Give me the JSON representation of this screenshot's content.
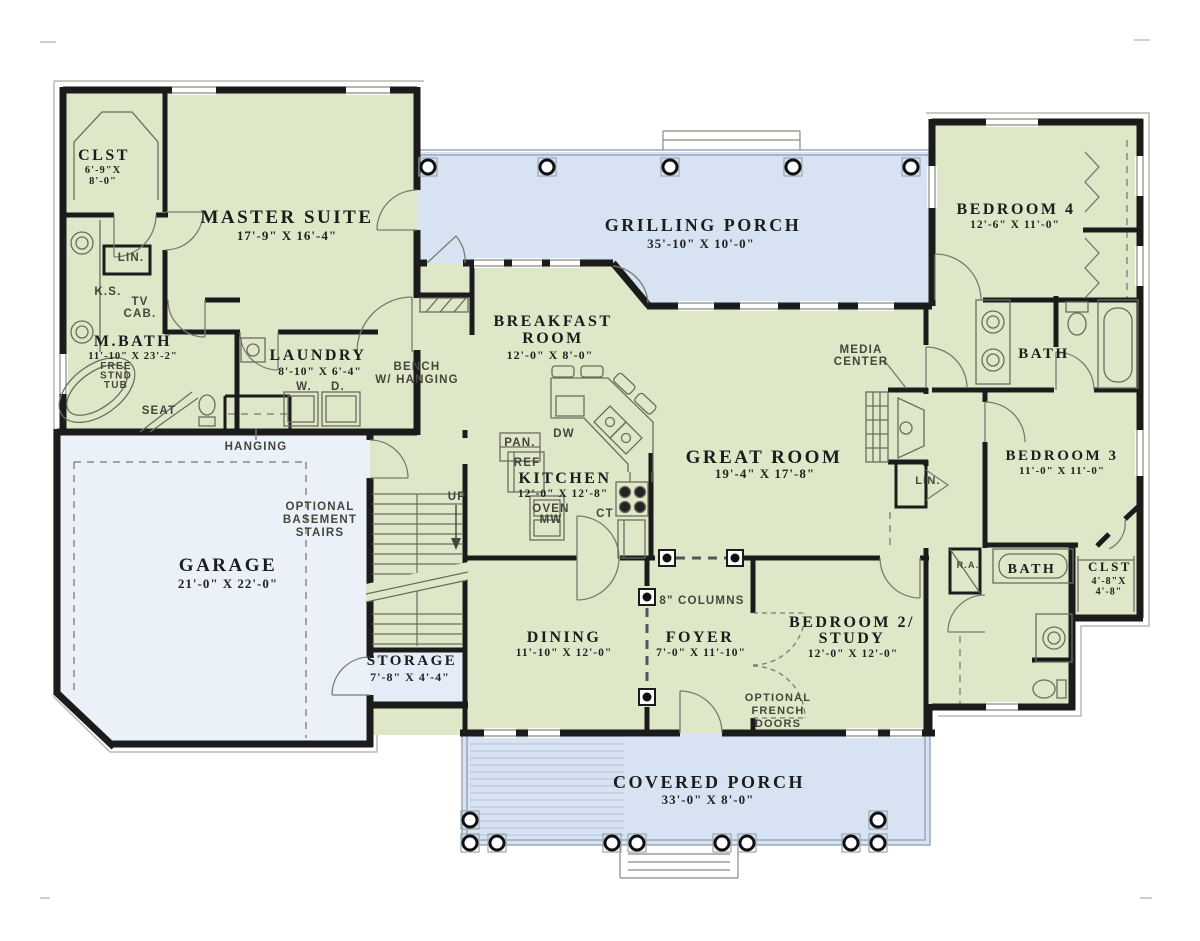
{
  "drawing": "single-story house first floor plan",
  "colors": {
    "wall": "#1b1b1b",
    "room_fill": "#dee8c9",
    "porch_fill": "#d7e3f2",
    "garage_fill": "#ebf1f8",
    "storage_fill": "#e3ecf7",
    "room_text": "#1c1c1c",
    "note_text": "#45453c",
    "fixture_line": "#6b6b5e"
  },
  "labels": [
    {
      "id": "clst-left-name",
      "cls": "room",
      "x": 104,
      "y": 160,
      "size": 16,
      "lines": [
        "CLST"
      ]
    },
    {
      "id": "clst-left-dim",
      "cls": "dim",
      "x": 103,
      "y": 173,
      "size": 10.5,
      "lh": 11,
      "lines": [
        "6'-9\"X",
        "8'-0\""
      ]
    },
    {
      "id": "master-suite-name",
      "cls": "room",
      "x": 287,
      "y": 223,
      "size": 19,
      "lines": [
        "MASTER SUITE"
      ]
    },
    {
      "id": "master-suite-dim",
      "cls": "dim",
      "x": 287,
      "y": 240,
      "size": 13,
      "lines": [
        "17'-9\" X 16'-4\""
      ]
    },
    {
      "id": "lin-left",
      "cls": "note",
      "x": 131,
      "y": 261,
      "size": 11.5,
      "lines": [
        "LIN."
      ]
    },
    {
      "id": "ks",
      "cls": "note",
      "x": 108,
      "y": 295,
      "size": 11.5,
      "lines": [
        "K.S."
      ]
    },
    {
      "id": "tv-cab",
      "cls": "note",
      "x": 140,
      "y": 305,
      "size": 11.5,
      "lh": 12,
      "lines": [
        "TV",
        "CAB."
      ]
    },
    {
      "id": "m-bath-name",
      "cls": "room",
      "x": 133,
      "y": 346,
      "size": 16,
      "lines": [
        "M.BATH"
      ]
    },
    {
      "id": "m-bath-dim",
      "cls": "dim",
      "x": 133,
      "y": 359,
      "size": 10.5,
      "lines": [
        "11'-10\" X 23'-2\""
      ]
    },
    {
      "id": "free-stnd-tub",
      "cls": "note",
      "x": 116,
      "y": 369,
      "size": 10,
      "lh": 9.5,
      "lines": [
        "FREE",
        "STND",
        "TUB"
      ]
    },
    {
      "id": "seat",
      "cls": "note",
      "x": 159,
      "y": 414,
      "size": 11.5,
      "lines": [
        "SEAT"
      ]
    },
    {
      "id": "hanging-left",
      "cls": "note",
      "x": 256,
      "y": 450,
      "size": 11.5,
      "lines": [
        "HANGING"
      ]
    },
    {
      "id": "laundry-name",
      "cls": "room",
      "x": 318,
      "y": 360,
      "size": 16,
      "lines": [
        "LAUNDRY"
      ]
    },
    {
      "id": "laundry-dim",
      "cls": "dim",
      "x": 320,
      "y": 375,
      "size": 11.5,
      "lines": [
        "8'-10\" X 6'-4\""
      ]
    },
    {
      "id": "washer",
      "cls": "note",
      "x": 304,
      "y": 390,
      "size": 11.5,
      "lines": [
        "W."
      ]
    },
    {
      "id": "dryer",
      "cls": "note",
      "x": 338,
      "y": 390,
      "size": 11.5,
      "lines": [
        "D."
      ]
    },
    {
      "id": "bench-hanging",
      "cls": "note",
      "x": 417,
      "y": 370,
      "size": 11.5,
      "lh": 13,
      "lines": [
        "BENCH",
        "W/ HANGING"
      ]
    },
    {
      "id": "garage-name",
      "cls": "room",
      "x": 228,
      "y": 571,
      "size": 19,
      "lines": [
        "GARAGE"
      ]
    },
    {
      "id": "garage-dim",
      "cls": "dim",
      "x": 228,
      "y": 588,
      "size": 13,
      "lines": [
        "21'-0\" X 22'-0\""
      ]
    },
    {
      "id": "optional-basement",
      "cls": "note",
      "x": 320,
      "y": 510,
      "size": 11.5,
      "lh": 13,
      "lines": [
        "OPTIONAL",
        "BASEMENT",
        "STAIRS"
      ]
    },
    {
      "id": "up",
      "cls": "note",
      "x": 457,
      "y": 500,
      "size": 11.5,
      "lines": [
        "UP"
      ]
    },
    {
      "id": "storage-name",
      "cls": "room",
      "x": 412,
      "y": 665,
      "size": 15,
      "lines": [
        "STORAGE"
      ]
    },
    {
      "id": "storage-dim",
      "cls": "dim",
      "x": 410,
      "y": 681,
      "size": 12,
      "lines": [
        "7'-8\" X 4'-4\""
      ]
    },
    {
      "id": "grilling-porch-name",
      "cls": "room",
      "x": 703,
      "y": 231,
      "size": 18,
      "lines": [
        "GRILLING PORCH"
      ]
    },
    {
      "id": "grilling-porch-dim",
      "cls": "dim",
      "x": 701,
      "y": 248,
      "size": 13,
      "lines": [
        "35'-10\" X 10'-0\""
      ]
    },
    {
      "id": "breakfast-name",
      "cls": "room",
      "x": 553,
      "y": 326,
      "size": 16,
      "lh": 17,
      "lines": [
        "BREAKFAST",
        "ROOM"
      ]
    },
    {
      "id": "breakfast-dim",
      "cls": "dim",
      "x": 550,
      "y": 359,
      "size": 12,
      "lines": [
        "12'-0\" X 8'-0\""
      ]
    },
    {
      "id": "media-center",
      "cls": "note",
      "x": 861,
      "y": 353,
      "size": 11.5,
      "lh": 12,
      "lines": [
        "MEDIA",
        "CENTER"
      ]
    },
    {
      "id": "kitchen-name",
      "cls": "room",
      "x": 565,
      "y": 483,
      "size": 16,
      "lines": [
        "KITCHEN"
      ]
    },
    {
      "id": "kitchen-dim",
      "cls": "dim",
      "x": 563,
      "y": 497,
      "size": 11.5,
      "lines": [
        "12'-0\" X 12'-8\""
      ]
    },
    {
      "id": "pan",
      "cls": "note",
      "x": 520,
      "y": 446,
      "size": 11.5,
      "lines": [
        "PAN."
      ]
    },
    {
      "id": "ref",
      "cls": "note",
      "x": 527,
      "y": 466,
      "size": 11.5,
      "lines": [
        "REF"
      ]
    },
    {
      "id": "oven-mw",
      "cls": "note",
      "x": 551,
      "y": 512,
      "size": 11.5,
      "lh": 11,
      "lines": [
        "OVEN",
        "MW"
      ]
    },
    {
      "id": "dw",
      "cls": "note",
      "x": 564,
      "y": 437,
      "size": 11.5,
      "lines": [
        "DW"
      ]
    },
    {
      "id": "ct",
      "cls": "note",
      "x": 605,
      "y": 517,
      "size": 11.5,
      "lines": [
        "CT"
      ]
    },
    {
      "id": "great-room-name",
      "cls": "room",
      "x": 764,
      "y": 463,
      "size": 19,
      "lines": [
        "GREAT ROOM"
      ]
    },
    {
      "id": "great-room-dim",
      "cls": "dim",
      "x": 765,
      "y": 478,
      "size": 13,
      "lines": [
        "19'-4\" X 17'-8\""
      ]
    },
    {
      "id": "lin-right",
      "cls": "note",
      "x": 928,
      "y": 484,
      "size": 11,
      "lines": [
        "LIN."
      ]
    },
    {
      "id": "columns-8",
      "cls": "note",
      "x": 702,
      "y": 604,
      "size": 11.5,
      "lines": [
        "8\" COLUMNS"
      ]
    },
    {
      "id": "dining-name",
      "cls": "room",
      "x": 564,
      "y": 642,
      "size": 16,
      "lines": [
        "DINING"
      ]
    },
    {
      "id": "dining-dim",
      "cls": "dim",
      "x": 564,
      "y": 656,
      "size": 11.5,
      "lines": [
        "11'-10\" X 12'-0\""
      ]
    },
    {
      "id": "foyer-name",
      "cls": "room",
      "x": 700,
      "y": 642,
      "size": 16,
      "lines": [
        "FOYER"
      ]
    },
    {
      "id": "foyer-dim",
      "cls": "dim",
      "x": 701,
      "y": 656,
      "size": 11.5,
      "lines": [
        "7'-0\" X 11'-10\""
      ]
    },
    {
      "id": "bedroom2-name",
      "cls": "room",
      "x": 852,
      "y": 627,
      "size": 16,
      "lh": 16,
      "lines": [
        "BEDROOM 2/",
        "STUDY"
      ]
    },
    {
      "id": "bedroom2-dim",
      "cls": "dim",
      "x": 853,
      "y": 657,
      "size": 11.5,
      "lines": [
        "12'-0\" X 12'-0\""
      ]
    },
    {
      "id": "optional-french",
      "cls": "note",
      "x": 778,
      "y": 701,
      "size": 11,
      "lh": 13,
      "lines": [
        "OPTIONAL",
        "FRENCH",
        "DOORS"
      ]
    },
    {
      "id": "covered-porch-name",
      "cls": "room",
      "x": 709,
      "y": 788,
      "size": 18,
      "lines": [
        "COVERED PORCH"
      ]
    },
    {
      "id": "covered-porch-dim",
      "cls": "dim",
      "x": 708,
      "y": 804,
      "size": 13,
      "lines": [
        "33'-0\" X 8'-0\""
      ]
    },
    {
      "id": "bedroom4-name",
      "cls": "room",
      "x": 1016,
      "y": 214,
      "size": 16,
      "lines": [
        "BEDROOM 4"
      ]
    },
    {
      "id": "bedroom4-dim",
      "cls": "dim",
      "x": 1015,
      "y": 228,
      "size": 11.5,
      "lines": [
        "12'-6\" X 11'-0\""
      ]
    },
    {
      "id": "bath-upper",
      "cls": "room",
      "x": 1044,
      "y": 358,
      "size": 15,
      "lines": [
        "BATH"
      ]
    },
    {
      "id": "bedroom3-name",
      "cls": "room",
      "x": 1062,
      "y": 460,
      "size": 15,
      "lines": [
        "BEDROOM 3"
      ]
    },
    {
      "id": "bedroom3-dim",
      "cls": "dim",
      "x": 1062,
      "y": 474,
      "size": 11,
      "lines": [
        "11'-0\" X 11'-0\""
      ]
    },
    {
      "id": "bath-lower",
      "cls": "room",
      "x": 1032,
      "y": 573,
      "size": 14,
      "lines": [
        "BATH"
      ]
    },
    {
      "id": "clst-right-name",
      "cls": "room",
      "x": 1110,
      "y": 571,
      "size": 13,
      "lines": [
        "CLST"
      ]
    },
    {
      "id": "clst-right-dim",
      "cls": "dim",
      "x": 1109,
      "y": 584,
      "size": 10,
      "lh": 10.5,
      "lines": [
        "4'-8\"X",
        "4'-8\""
      ]
    },
    {
      "id": "ra",
      "cls": "note",
      "x": 968,
      "y": 568,
      "size": 9,
      "lines": [
        "R.A."
      ]
    }
  ]
}
